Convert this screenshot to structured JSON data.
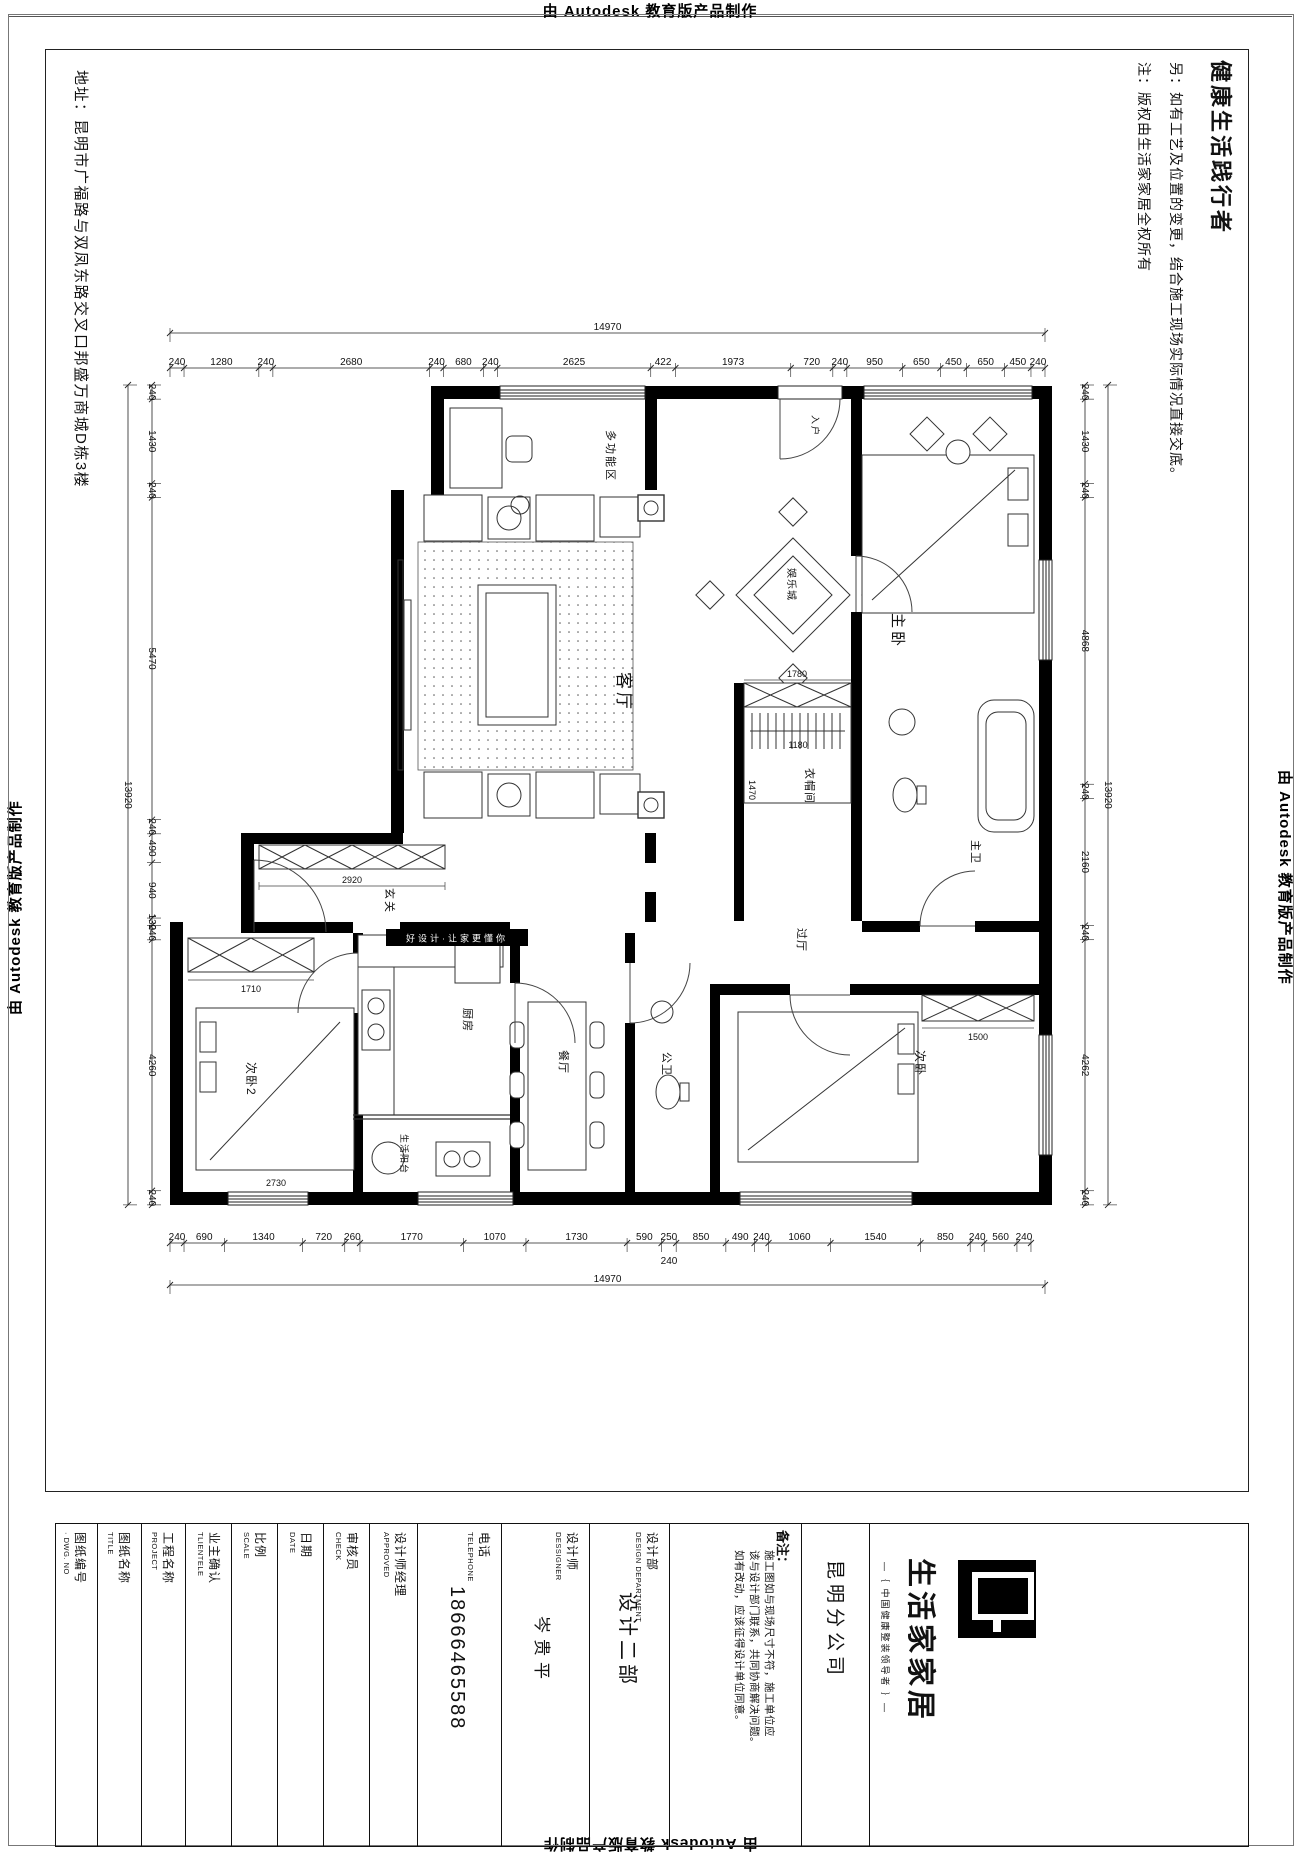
{
  "stamps": {
    "top": "由 Autodesk 教育版产品制作",
    "bottom": "由 Autodesk 教育版产品制作",
    "left": "由 Autodesk 教育版产品制作",
    "right": "由 Autodesk 教育版产品制作"
  },
  "sheet": {
    "right_title": "健康生活践行者",
    "note_alt": "另：如有工艺及位置的变更，结合施工现场实际情况直接交底。",
    "note_copyright": "注：版权由生活家家居全权所有",
    "address": "地址：昆明市广福路与双凤东路交叉口邦盛万商城D栋3楼"
  },
  "plan": {
    "watermark": "好设计·让家更懂你",
    "rooms": [
      "多功能区",
      "入户",
      "主卧",
      "娱乐城",
      "客厅",
      "衣帽间",
      "主卫",
      "玄关",
      "过厅",
      "次卧2",
      "厨房",
      "餐厅",
      "公卫",
      "次卧",
      "生活阳台"
    ]
  },
  "dims": {
    "top": {
      "segments": [
        "240",
        "1280",
        "240",
        "2680",
        "240",
        "680",
        "240",
        "2625",
        "422",
        "1973",
        "720",
        "240",
        "950",
        "650",
        "450",
        "650",
        "450",
        "240"
      ],
      "overall": "14970"
    },
    "bottom": {
      "segments": [
        "240",
        "690",
        "1340",
        "720",
        "260",
        "1770",
        "1070",
        "1730",
        "590",
        "250",
        "850",
        "490",
        "240",
        "1060",
        "1540",
        "850",
        "240",
        "560",
        "240"
      ],
      "sub": "240",
      "overall": "14970"
    },
    "left": {
      "segments": [
        "240",
        "1430",
        "240",
        "5470",
        "240",
        "490",
        "940",
        "130",
        "240",
        "4260",
        "240"
      ],
      "overall": "13920"
    },
    "right": {
      "segments": [
        "240",
        "1430",
        "240",
        "4868",
        "240",
        "2160",
        "240",
        "4262",
        "240"
      ],
      "overall": "13920"
    },
    "interior": [
      "2920",
      "1780",
      "1180",
      "1470",
      "1710",
      "1500",
      "2730"
    ]
  },
  "titleblock": {
    "fields": [
      {
        "cn": "图纸编号",
        "en": "· DWG. NO",
        "value": ""
      },
      {
        "cn": "图纸名称",
        "en": "TITLE",
        "value": ""
      },
      {
        "cn": "工程名称",
        "en": "PROJECT",
        "value": ""
      },
      {
        "cn": "业主确认",
        "en": "TLIENTELE",
        "value": ""
      },
      {
        "cn": "比例",
        "en": "SCALE",
        "value": ""
      },
      {
        "cn": "日期",
        "en": "DATE",
        "value": ""
      },
      {
        "cn": "审核员",
        "en": "CHECK",
        "value": ""
      },
      {
        "cn": "设计师经理",
        "en": "APPROVED",
        "value": ""
      },
      {
        "cn": "电话",
        "en": "TELEPHONE",
        "value": "18666465588"
      },
      {
        "cn": "设计师",
        "en": "DESSIGNER",
        "value": "岑贵平"
      },
      {
        "cn": "设计部",
        "en": "DESIGN DEPARTMENT",
        "value": "设计二部"
      }
    ],
    "note": {
      "label": "备注：",
      "lines": [
        "施工图如与现场尺寸不符，施工单位应",
        "该与设计部门联系，共同协商解决问题。",
        "如有改动，应该征得设计单位同意。"
      ]
    },
    "company": "昆明分公司",
    "brand": {
      "name": "生活家家居",
      "tagline": "—｛ 中国健康整装领导者 ｝—"
    }
  }
}
